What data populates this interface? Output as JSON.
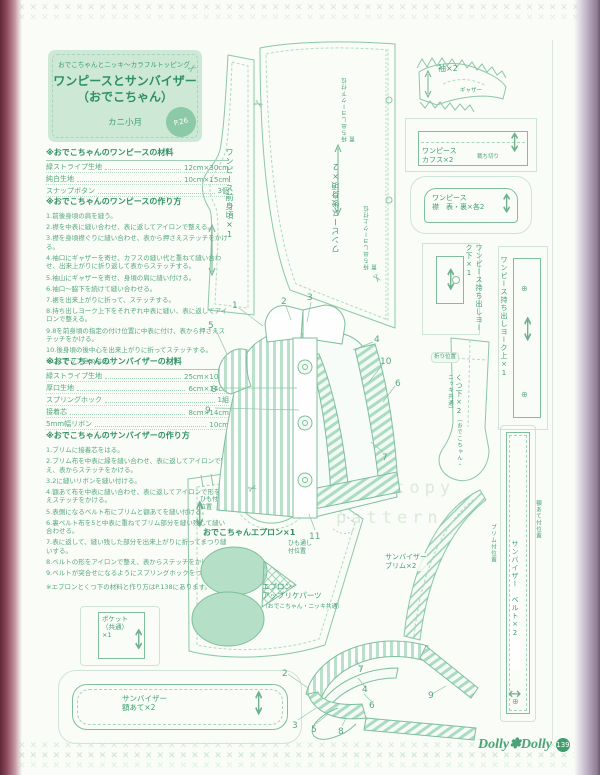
{
  "icons": {
    "stitch": "✕",
    "scissors": "✂",
    "grain_arrow": "↕",
    "double_arrow": "↔",
    "snap": "⊕"
  },
  "title_box": {
    "series": "おでこちゃんとニッキ〜カラフルトッピング",
    "title_line1": "ワンピースとサンバイザー",
    "title_line2": "（おでこちゃん）",
    "maker": "カニ小月",
    "badge": "P.26"
  },
  "materials_dress": {
    "header": "※おでこちゃんのワンピースの材料",
    "rows": [
      {
        "name": "緑ストライプ生地",
        "value": "12cm×30cm"
      },
      {
        "name": "純白生地",
        "value": "10cm×15cm"
      },
      {
        "name": "スナップボタン",
        "value": "3個"
      }
    ]
  },
  "howto_dress": {
    "header": "※おでこちゃんのワンピースの作り方",
    "steps": [
      "1.前後身頃の肩を縫う。",
      "2.襟を中表に縫い合わせ、表に返してアイロンで整える。",
      "3.襟を身頃襟ぐりに縫い合わせ、表から押さえステッチをかける。",
      "4.袖口にギャザーを寄せ、カフスの縫い代と重ねて縫い合わせ、出来上がりに折り返して表からステッチする。",
      "5.袖山にギャザーを寄せ、身頃の肩に縫い付ける。",
      "6.袖口〜脇下を続けて縫い合わせる。",
      "7.裾を出来上がりに折って、ステッチする。",
      "8.持ち出しヨーク上下をそれぞれ中表に縫い、表に返してアイロンで整える。",
      "9.8を前身頃の指定の付け位置に中表に付け、表から押さえステッチをかける。",
      "10.後身頃の後中心を出来上がりに折ってステッチする。",
      "11.スナップをつける。"
    ]
  },
  "materials_visor": {
    "header": "※おでこちゃんのサンバイザーの材料",
    "rows": [
      {
        "name": "緑ストライプ生地",
        "value": "25cm×10cm"
      },
      {
        "name": "厚口生地",
        "value": "6cm×14cm"
      },
      {
        "name": "スプリングホック",
        "value": "1組"
      },
      {
        "name": "接着芯",
        "value": "8cm×14cm"
      },
      {
        "name": "5mm幅リボン",
        "value": "10cm"
      }
    ]
  },
  "howto_visor": {
    "header": "※おでこちゃんのサンバイザーの作り方",
    "steps": [
      "1.ブリムに接着芯をはる。",
      "2.ブリム布を中表に縁を縫い合わせ、表に返してアイロンで整え、表からステッチをかける。",
      "3.2に縫いリボンを縫い付ける。",
      "4.額あて布を中表に縫い合わせ、表に返してアイロンで形を整えステッチをかける。",
      "5.表側になるベルト布にブリムと額あてを縫い付ける。",
      "6.裏ベルト布を5と中表に重ねてブリム部分を縫い残して縫い合わせる。",
      "7.表に返して、縫い残した部分を出来上がりに折ってまつり縫いする。",
      "8.ベルトの形をアイロンで整え、表からステッチをかける。",
      "9.ベルトが突合せになるようにスプリングホックをつける。"
    ],
    "note": "※エプロンとくつ下の材料と作り方はP.138にあります。"
  },
  "pieces": {
    "front_bodice": {
      "l1": "ワンピース",
      "l2": "前身頃×1"
    },
    "back_bodice": {
      "l1": "ワンピース",
      "l2": "後身頃×2"
    },
    "back_note_lower": {
      "l1": "持ち出しヨーク下",
      "l2": "付位置"
    },
    "back_note_upper": "持ち出しヨーク上付位置",
    "sleeve": "袖×2",
    "sleeve_gather": "ギャザー",
    "cuff": {
      "l1": "ワンピース",
      "l2": "カフス×2"
    },
    "cuff_note": "裁ち切り",
    "collar": {
      "l1": "ワンピース",
      "l2": "襟　表・裏×各2"
    },
    "yoke_lower": {
      "l1": "ワンピース",
      "l2": "持ち出しヨーク下×1"
    },
    "yoke_upper": {
      "l1": "ワンピース",
      "l2": "持ち出しヨーク上×1"
    },
    "sock": {
      "l1": "くつ下×2",
      "l2": "（おでこちゃん・ニッキ共通）"
    },
    "sock_fold": "折り位置",
    "apron": "おでこちゃんエプロン×1",
    "apron_strap": {
      "l1": "ひも付",
      "l2": "位置"
    },
    "apron_loop": {
      "l1": "ひも通し",
      "l2": "付位置"
    },
    "applique": {
      "l1": "エプロン",
      "l2": "アップリケパーツ",
      "l3": "（おでこちゃん・ニッキ共通）"
    },
    "pocket": {
      "l1": "ポケット",
      "l2": "（共通）",
      "l3": "×1"
    },
    "visor_forehead": {
      "l1": "サンバイザー",
      "l2": "額あて×2"
    },
    "visor_brim": {
      "l1": "サンバイザー",
      "l2": "ブリム×2"
    },
    "visor_belt": "サンバイザー　ベルト×2",
    "brim_pos": "ブリム付位置",
    "forehead_pos": "額あて付位置"
  },
  "watermark": {
    "line1": "100% copy",
    "line2": "pattern"
  },
  "callouts": {
    "dress": [
      "1",
      "2",
      "3",
      "4",
      "5",
      "6",
      "7",
      "8",
      "9",
      "10",
      "11"
    ],
    "visor": [
      "2",
      "3",
      "4",
      "5",
      "6",
      "7",
      "8",
      "9"
    ]
  },
  "footer": {
    "logo": "Dolly✽Dolly",
    "page_badge": "139"
  }
}
